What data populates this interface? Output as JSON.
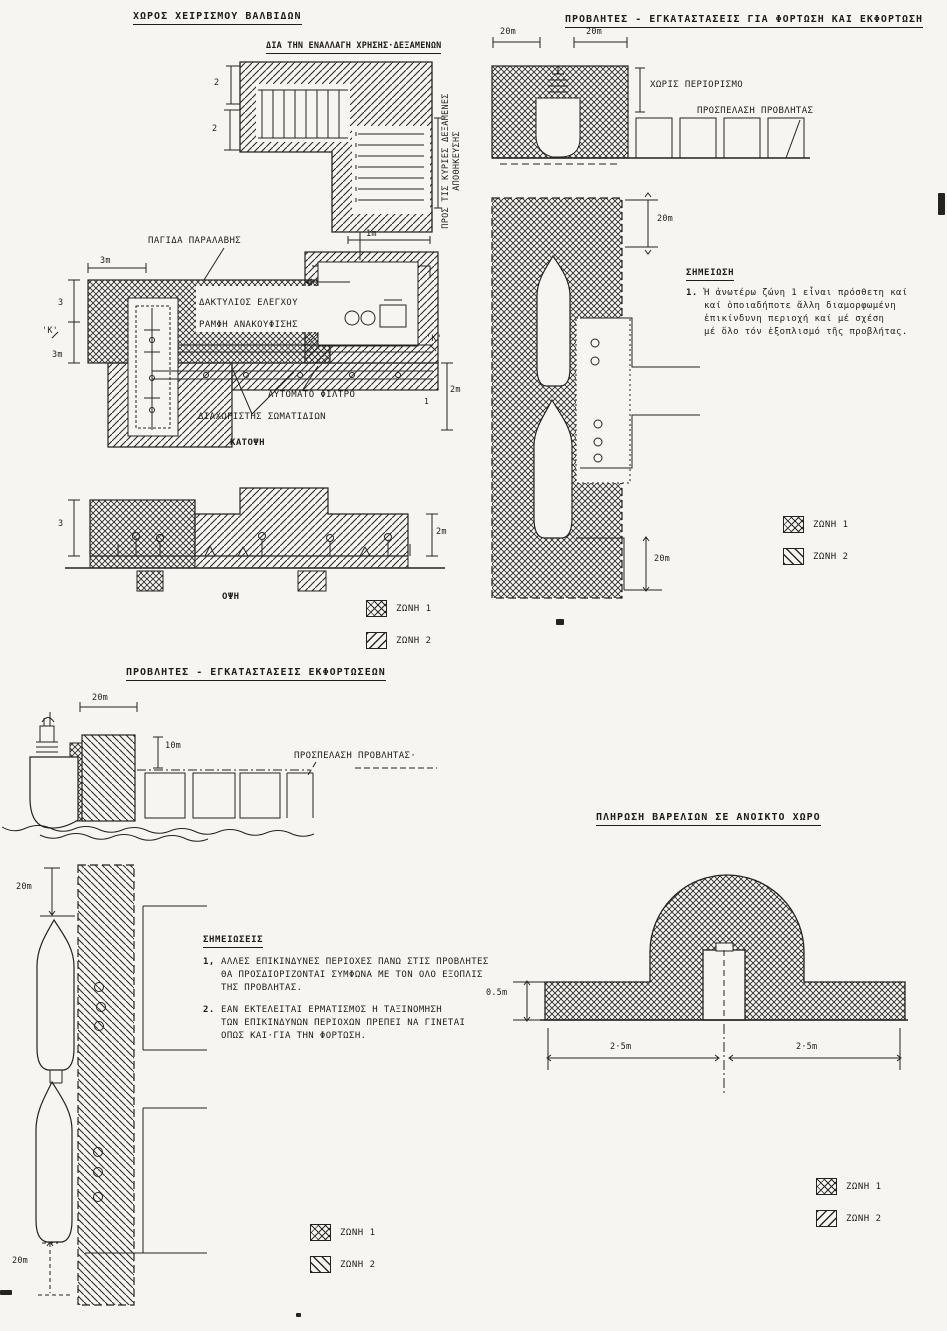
{
  "page": {
    "paper": "#f6f5f1",
    "ink": "#1d1d1d"
  },
  "legend": {
    "zone1": "ΖΩΝΗ 1",
    "zone2": "ΖΩΝΗ 2"
  },
  "valve": {
    "title": "ΧΩΡΟΣ ΧΕΙΡΙΣΜΟΥ ΒΑΛΒΙΔΩΝ",
    "alt_use": "ΔΙΑ ΤΗΝ ΕΝΑΛΛΑΓΗ ΧΡΗΣΗΣ·ΔΕΞΑΜΕΝΩΝ",
    "to_tanks": "ΠΡΟΣ ΤΙΣ ΚΥΡΙΕΣ ΔΕΞΑΜΕΝΕΣ\nΑΠΟΘΗΚΕΥΣΗΣ",
    "trap": "ΠΑΓΙΔΑ ΠΑΡΑΛΑΒΗΣ",
    "control_ring": "ΔΑΚΤΥΛΙΟΣ ΕΛΕΓΧΟΥ",
    "relief": "ΡΑΜΦΗ ΑΝΑΚΟΥΦΙΣΗΣ",
    "filter": "ΑΥΤΟΜΑΤΟ ΦΙΛΤΡΟ",
    "separator": "ΔΙΑΧΩΡΙΣΤΗΣ ΣΩΜΑΤΙΔΙΩΝ",
    "plan_caption": "ΚΑΤΟΨΗ",
    "elev_caption": "ΟΨΗ",
    "dims": {
      "h2a": "2",
      "h2b": "2",
      "one_m": "1m",
      "three_m_top": "3m",
      "three_left": "3",
      "k_left": "'Κ'",
      "three_m_left": "3m",
      "k_right": "'Κ'",
      "two_m_right": "2m",
      "one_small": "1",
      "three_elev": "3",
      "two_m_elev": "2m"
    }
  },
  "loading": {
    "title": "ΠΡΟΒΛΗΤΕΣ - ΕΓΚΑΤΑΣΤΑΣΕΙΣ ΓΙΑ ΦΟΡΤΩΣΗ ΚΑΙ ΕΚΦΟΡΤΩΣΗ",
    "no_limit": "ΧΩΡΙΣ ΠΕΡΙΟΡΙΣΜΟ",
    "access": "ΠΡΟΣΠΕΛΑΣΗ ΠΡΟΒΛΗΤΑΣ",
    "note_heading": "ΣΗΜΕΙΩΣΗ",
    "note_no": "1.",
    "note_body": "Ἡ ἀνωτέρω ζώνη 1 εἶναι πρόσθετη καί\nκαί ὁποιαδήποτε ἄλλη διαμορφωμένη\nἐπικίνδυνη περιοχή καί μέ σχέση\nμέ ὅλο τόν ἐξοπλισμό τῆς προβλήτας.",
    "dims": {
      "w20a": "20m",
      "w20b": "20m",
      "p20top": "20m",
      "p20bot": "20m"
    }
  },
  "unloading": {
    "title": "ΠΡΟΒΛΗΤΕΣ -  ΕΓΚΑΤΑΣΤΑΣΕΙΣ ΕΚΦΟΡΤΩΣΕΩΝ",
    "access": "ΠΡΟΣΠΕΛΑΣΗ ΠΡΟΒΛΗΤΑΣ·",
    "notes_heading": "ΣΗΜΕΙΩΣΕΙΣ",
    "n1_no": "1,",
    "n1": "ΑΛΛΕΣ ΕΠΙΚΙΝΔΥΝΕΣ ΠΕΡΙΟΧΕΣ ΠΑΝΩ ΣΤΙΣ ΠΡΟΒΛΗΤΕΣ\nΘΑ ΠΡΟΣΔΙΟΡΙΖΟΝΤΑΙ ΣΥΜΦΩΝΑ ΜΕ ΤΟΝ ΟΛΟ ΕΞΟΠΛΙΣ\nΤΗΣ ΠΡΟΒΛΗΤΑΣ.",
    "n2_no": "2.",
    "n2": "ΕΑΝ ΕΚΤΕΛΕΙΤΑΙ ΕΡΜΑΤΙΣΜΟΣ      Η ΤΑΞΙΝΟΜΗΣΗ\nΤΩΝ ΕΠΙΚΙΝΔΥΝΩΝ ΠΕΡΙΟΧΩΝ ΠΡΕΠΕΙ ΝΑ ΓΙΝΕΤΑΙ\nΟΠΩΣ ΚΑΙ·ΓΙΑ ΤΗΝ ΦΟΡΤΩΣΗ.",
    "dims": {
      "w20": "20m",
      "h10": "10m",
      "p20top": "20m",
      "p20bot": "20m"
    }
  },
  "barrel": {
    "title": "ΠΛΗΡΩΣΗ ΒΑΡΕΛΙΩΝ ΣΕ ΑΝΟΙΚΤΟ ΧΩΡΟ",
    "dims": {
      "h05": "0.5m",
      "w25l": "2·5m",
      "w25r": "2·5m"
    }
  }
}
